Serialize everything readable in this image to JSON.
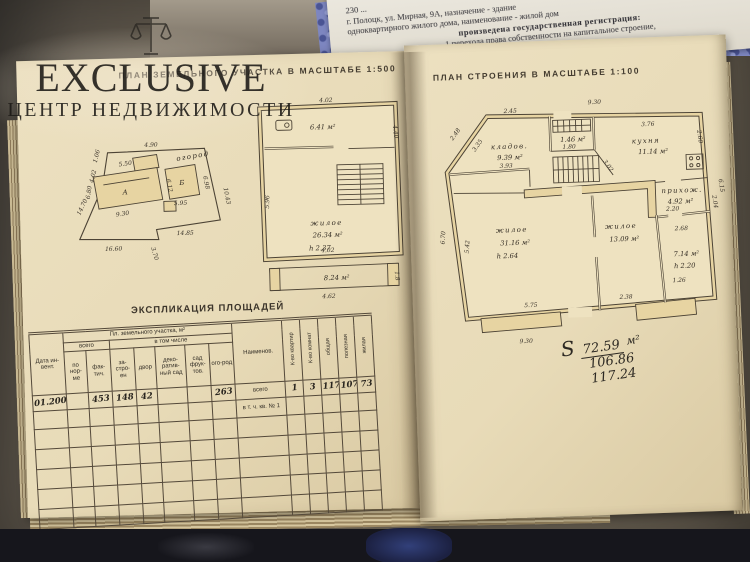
{
  "watermark": {
    "title": "EXCLUSIVE",
    "subtitle": "ЦЕНТР НЕДВИЖИМОСТИ"
  },
  "typed_paper": {
    "lines": [
      "230 ...",
      "г. Полоцк, ул. Мирная, 9А, назначение - здание",
      "одноквартирного жилого дома, наименование - жилой дом",
      "произведена государственная регистрация:",
      "1  перехода  права  собственности  на  капитальное  строение,",
      "правообладатель  гражданин  Республики  Беларусь  Богданова  Нина",
      "форма собственности - частная"
    ]
  },
  "left_page": {
    "title": "ПЛАН ЗЕМЕЛЬНОГО УЧАСТКА В МАСШТАБЕ 1:500",
    "plot": {
      "garden_label": "огород",
      "house_label": "А",
      "annex_label": "Б",
      "dim_top": "4.90",
      "dim_right": "10.43",
      "dim_bottom_right": "14.85",
      "dim_step": "3.70",
      "dim_bottom": "16.60",
      "dim_left": "14.70",
      "dim_tl1": "1.06",
      "dim_tl2": "4.02",
      "dim_house_top": "5.50",
      "dim_house_bottom": "9.30",
      "dim_house_left": "6.80",
      "dim_house_right": "6.12",
      "dim_annex_bottom": "5.95",
      "dim_annex_right": "6.98"
    },
    "upper_plan": {
      "dim_top": "4.02",
      "room1_area": "6.41 м²",
      "dim_right": "4.40",
      "dim_left": "5.96",
      "room2_name": "жилое",
      "room2_area": "26.34 м²",
      "room2_h": "h 2.37",
      "dim_bottom": "4.02",
      "porch_area": "8.24 м²",
      "porch_dim": "4.62",
      "porch_h": "1.8"
    },
    "explication": {
      "title": "ЭКСПЛИКАЦИЯ ПЛОЩАДЕЙ",
      "h_date": "Дата ин-вент.",
      "h_land": "Пл. земельного участка, м²",
      "h_total": "всего",
      "h_incl": "в том числе",
      "h_cols": [
        "по нор-ме",
        "фак-тич.",
        "за-стро-ен",
        "двор",
        "деко-ратив-ный сад",
        "сад фрук-тов.",
        "ого-род"
      ],
      "h_name": "Наименов.",
      "h_rot": [
        "К-во квартир",
        "К-во комнат",
        "общая",
        "полезная",
        "жилая"
      ],
      "r1": {
        "date": "01.2001",
        "c1": "",
        "c2": "453",
        "c3": "148",
        "c4": "42",
        "c5": "",
        "c6": "",
        "c7": "263",
        "name": "всего",
        "k1": "1",
        "k2": "3",
        "k3": "117",
        "k4": "107",
        "k5": "73"
      },
      "r2_name": "в т. ч. кв. № 1"
    }
  },
  "right_page": {
    "title": "ПЛАН СТРОЕНИЯ В МАСШТАБЕ 1:100",
    "plan": {
      "dim_top": "9.30",
      "dim_top_left": "2.45",
      "dim_kitchen_top": "3.76",
      "dim_right_upper": "2.60",
      "dim_right": "6.15",
      "dim_diag_out": "2.48",
      "dim_diag_in": "3.35",
      "room_storage": "кладов.",
      "room_storage_area": "9.39 м²",
      "dim_storage": "3.93",
      "room_boiler_area": "1.46 м²",
      "dim_boiler": "1.80",
      "dim_diag2": "3.02",
      "room_kitchen": "кухня",
      "room_kitchen_area": "11.14 м²",
      "room_hall": "прихож.",
      "room_hall_area": "4.92 м²",
      "dim_hall": "2.20",
      "dim_hall_right": "2.04",
      "room_living1": "жилое",
      "room_living1_area": "31.16 м²",
      "room_living1_h": "h 2.64",
      "room_living2": "жилое",
      "room_living2_area": "13.09 м²",
      "room_veranda_area": "7.14 м²",
      "room_veranda_h": "h 2.20",
      "dim_veranda_top": "2.68",
      "dim_veranda": "1.26",
      "dim_left_in": "5.42",
      "dim_left_out": "6.70",
      "dim_bottom_room": "5.75",
      "dim_bottom_right": "2.38",
      "dim_bottom": "9.30"
    },
    "totals": {
      "s": "S",
      "v1": "72.59",
      "v2": "106.86",
      "v3": "117.24",
      "unit": "м²"
    }
  }
}
